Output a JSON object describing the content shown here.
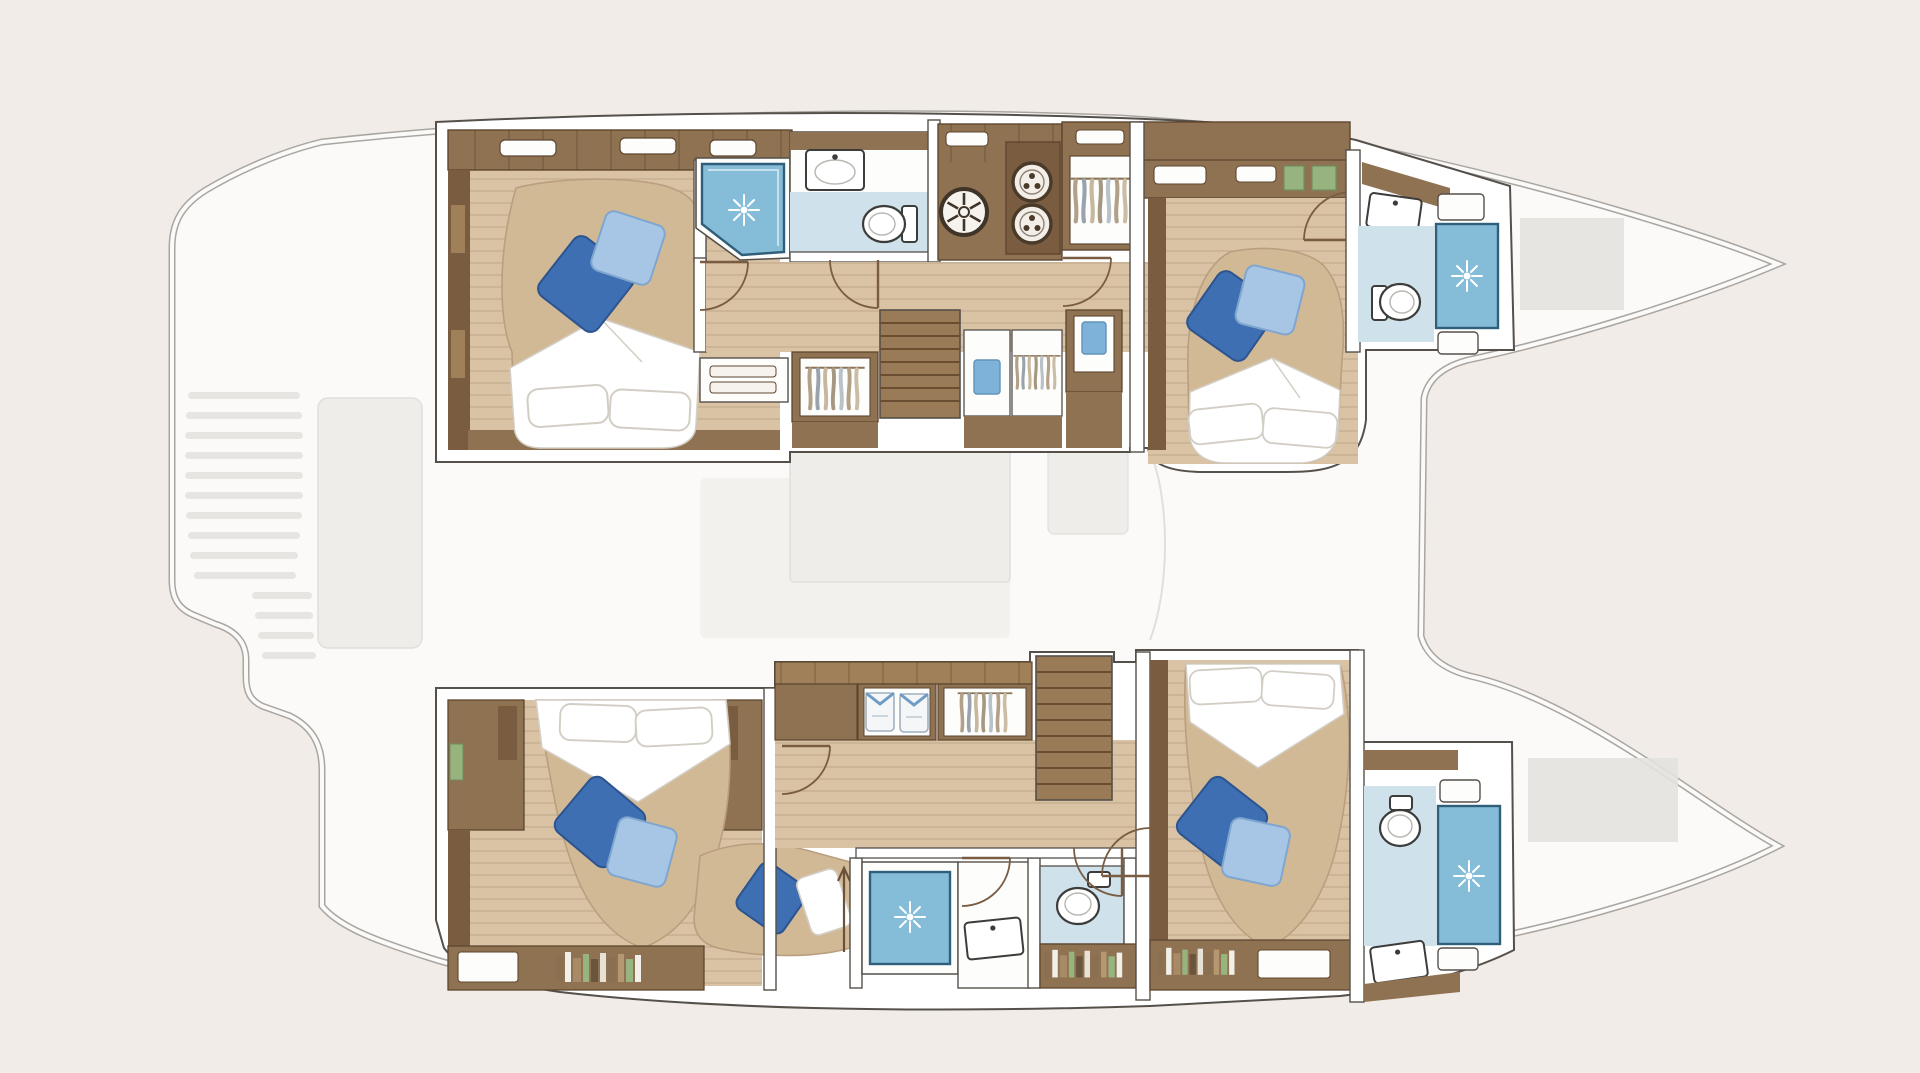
{
  "figure": {
    "kind": "catamaran-interior-floor-plan",
    "view": "top-down deck plan",
    "visible_text": [],
    "hulls": [
      {
        "id": "port-hull",
        "position": "top",
        "rooms": [
          {
            "name": "aft-cabin",
            "furniture": [
              "double-bed",
              "white-pillows",
              "blue-throw-pillows",
              "side-cabinets"
            ]
          },
          {
            "name": "aft-bathroom",
            "furniture": [
              "corner-shower",
              "washbasin",
              "toilet"
            ]
          },
          {
            "name": "galley-corridor",
            "furniture": [
              "deck-hatch",
              "twin-burners",
              "hanging-wardrobe",
              "long-locker",
              "stairs-to-saloon",
              "towel-lockers",
              "drawer-unit"
            ]
          },
          {
            "name": "forward-cabin",
            "furniture": [
              "double-bed",
              "white-pillows",
              "blue-throw-pillows"
            ]
          },
          {
            "name": "forward-bathroom",
            "furniture": [
              "washbasin",
              "toilet",
              "shower-cubicle",
              "shower-seat"
            ]
          }
        ]
      },
      {
        "id": "starboard-hull",
        "position": "bottom",
        "rooms": [
          {
            "name": "aft-cabin",
            "furniture": [
              "double-bed",
              "white-pillows",
              "blue-throw-pillows",
              "chaise-seat",
              "bookshelf"
            ]
          },
          {
            "name": "aft-bathroom",
            "furniture": [
              "shower-cubicle",
              "washbasin",
              "toilet-room"
            ]
          },
          {
            "name": "corridor",
            "furniture": [
              "folded-shirt-locker",
              "hanging-wardrobe",
              "stairs-to-saloon",
              "bookshelf"
            ]
          },
          {
            "name": "forward-cabin",
            "furniture": [
              "double-bed",
              "white-pillows",
              "blue-throw-pillows",
              "bookshelf"
            ]
          },
          {
            "name": "forward-bathroom",
            "furniture": [
              "toilet",
              "shower-cubicle",
              "washbasin"
            ]
          }
        ]
      }
    ],
    "ghost_areas": [
      "aft-cockpit-steps",
      "saloon",
      "foredeck-lockers",
      "bow-trampoline-area"
    ],
    "icons": {
      "water-jet-icon": "white starburst on shower floor",
      "deck-hatch-icon": "round hatch with spokes",
      "burner-icon": "round cooktop burner",
      "door-swing-icon": "quarter-circle door arc",
      "hanging-clothes-icon": "wavy garment strokes on rail",
      "folded-shirt-icon": "folded tee with blue collar",
      "book-row-icon": "row of book spines",
      "entry-arrow-icon": "companionway direction arrow"
    }
  },
  "colors": {
    "bg": "#f1ece7",
    "hull-fill": "#fbfaf8",
    "hull-stroke": "#a9a6a2",
    "ghost": "#edebe7",
    "ghost-line": "#dedcd7",
    "ghost-dark": "#e4e2de",
    "wall": "#ffffff",
    "wall-line": "#55504a",
    "wood": "#8f7252",
    "wood-dark": "#7a5c40",
    "wood-light": "#a08059",
    "wood-line": "#5d462f",
    "floor": "#d9c3a4",
    "bed": "#d2b995",
    "fabric": "#ffffff",
    "fabric-shade": "#d3cec5",
    "pillow-dark": "#3e6fb2",
    "pillow-dark-edge": "#2c548f",
    "pillow-light": "#a7c6e5",
    "pillow-light-edge": "#7fa6cf",
    "bath": "#cfe1ea",
    "shower": "#85bdd9",
    "shower-frame": "#2f5f7b",
    "fixture": "#3c3c3a",
    "towel": "#7fb2d8",
    "book-green": "#97b37e",
    "stair": "#9a7b57",
    "stair-line": "#6a4e32",
    "door": "#7a5c42",
    "arrow": "#6b503a"
  }
}
